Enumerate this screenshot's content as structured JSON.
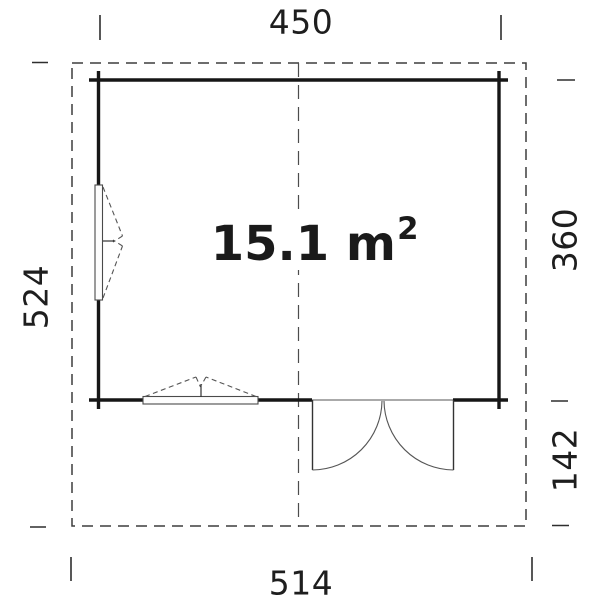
{
  "plan": {
    "area": {
      "value_unit": "15.1 m",
      "superscript": "2"
    },
    "dimensions": {
      "top": "450",
      "left": "524",
      "right_upper": "360",
      "right_lower": "142",
      "bottom": "514"
    }
  },
  "colors": {
    "background": "#ffffff",
    "wall_ink": "#161616",
    "thin_ink": "#4a4a4a",
    "text_ink": "#1e1e1e"
  }
}
